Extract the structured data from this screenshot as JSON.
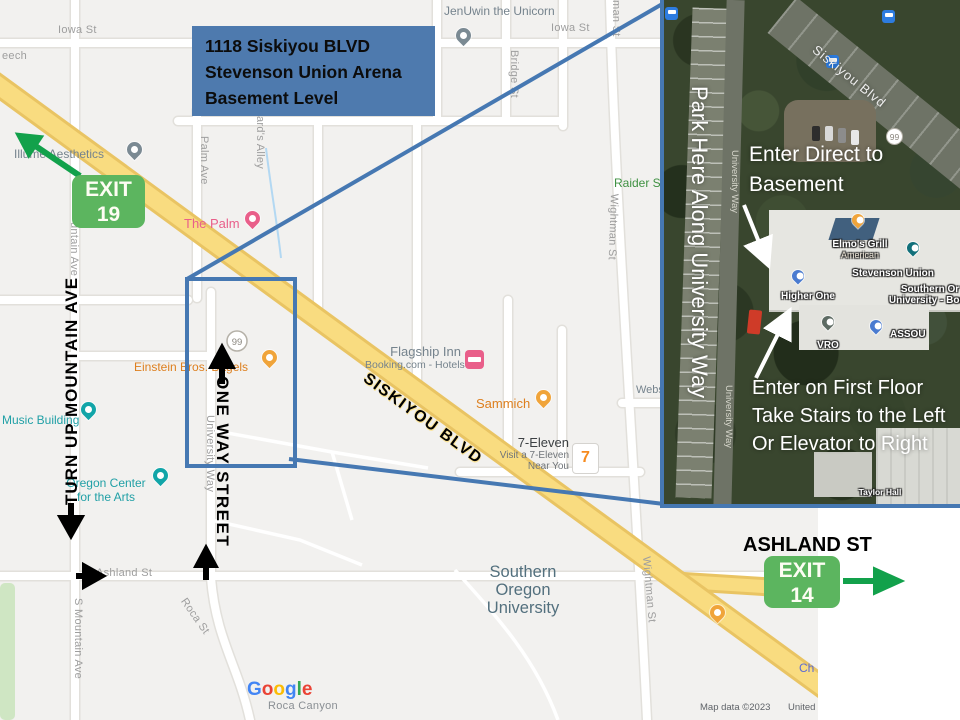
{
  "title_box": {
    "lines": [
      "1118 Siskiyou BLVD",
      "Stevenson Union Arena",
      "Basement Level"
    ]
  },
  "exits": {
    "exit19": {
      "word": "EXIT",
      "number": "19"
    },
    "exit14": {
      "word": "EXIT",
      "number": "14"
    }
  },
  "annotations": {
    "siskiyou_blvd": "SISKIYOU BLVD",
    "ashland_st": "ASHLAND ST",
    "turn_up": "TURN UP MOUNTAIN AVE",
    "one_way": "ONE WAY STREET"
  },
  "streets": {
    "iowa_a": "Iowa St",
    "iowa_b": "Iowa St",
    "beech_partial": "eech",
    "palm_ave": "Palm Ave",
    "alley": "ard's Alley",
    "bridge_st": "Bridge St",
    "man_st_partial": "man St",
    "wightman_a": "Wightman St",
    "wightman_b": "Wightman St",
    "university_way": "University Way",
    "mountain_partial": "untain Ave",
    "s_mountain_ave": "S Mountain Ave",
    "roca_st": "Roca St",
    "ashland_st": "Ashland St",
    "hwy99": "99"
  },
  "pois": {
    "jenuwin": "JenUwin the Unicorn",
    "illume": "Illume Aesthetics",
    "the_palm": "The Palm",
    "flagship": "Flagship Inn",
    "flagship_sub": "Booking.com - Hotels",
    "sammich": "Sammich",
    "seven_eleven": "7-Eleven",
    "seven_eleven_sub1": "Visit a 7-Eleven",
    "seven_eleven_sub2": "Near You",
    "seven_glyph": "7",
    "music": "Music Building",
    "arts_center_1": "Oregon Center",
    "arts_center_2": "for the Arts",
    "einstein": "Einstein Bros. Bagels",
    "sou_1": "Southern",
    "sou_2": "Oregon",
    "sou_3": "University",
    "raider_partial": "Raider S",
    "webster_partial": "Webs",
    "church_partial": "Ch",
    "roca_canyon": "Roca Canyon"
  },
  "footer": {
    "logo_letters": [
      "G",
      "o",
      "o",
      "g",
      "l",
      "e"
    ],
    "attribution": "Map data ©2023",
    "country": "United States"
  },
  "inset": {
    "street": "Siskiyou Blvd",
    "park_note": "Park Here Along University Way",
    "basement_note_1": "Enter Direct to",
    "basement_note_2": "Basement",
    "first_floor_note_1": "Enter on First Floor",
    "first_floor_note_2": "Take Stairs to the Left",
    "first_floor_note_3": "Or Elevator to Right",
    "university_way_a": "University Way",
    "university_way_b": "University Way",
    "hwy99": "99",
    "places": {
      "elmos": "Elmo's Grill",
      "elmos_type": "American",
      "stevenson": "Stevenson Union",
      "bookstore_1": "Southern Or",
      "bookstore_2": "University - Book",
      "higher_one": "Higher One",
      "vro": "VRO",
      "assou": "ASSOU",
      "taylor": "Taylor Hall"
    }
  },
  "colors": {
    "callout_blue": "#4678b2",
    "title_bg": "#4e7aae",
    "exit_green": "#5cb55f",
    "arrow_green": "#12a14b",
    "road_yellow": "#f9dc7f"
  }
}
